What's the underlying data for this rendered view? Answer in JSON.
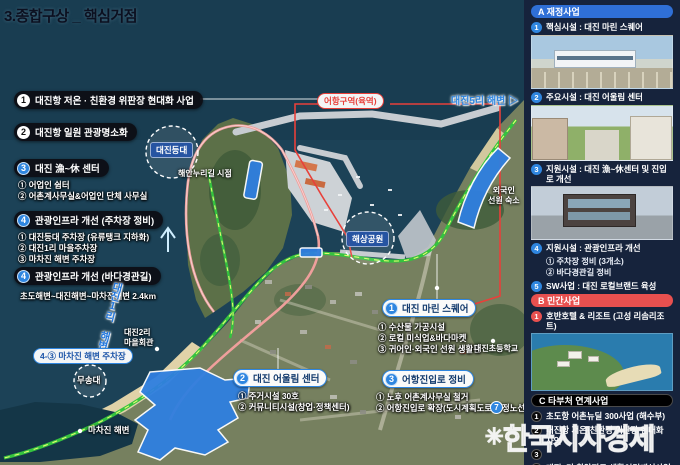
{
  "title": "3.종합구상 _ 핵심거점",
  "watermark": {
    "symbol": "✳",
    "text": "한국시사경제"
  },
  "colors": {
    "section_a": "#2f6fd6",
    "section_b": "#e8504f",
    "section_c": "#000000",
    "route_green": "#35c33f",
    "route_pink": "#ef9f9c",
    "boundary_red": "#e8403a",
    "site_blue": "#2f7fe0"
  },
  "map": {
    "callouts_left": [
      {
        "num": "1",
        "label": "대진항 저온 · 친환경 위판장 현대화 사업"
      },
      {
        "num": "2",
        "label": "대진항 일원 관광명소화"
      },
      {
        "num": "3",
        "label": "대진 漁~休 센터",
        "subs": [
          "① 어업인 쉼터",
          "② 어촌계사무실&어업인 단체 사무실"
        ]
      },
      {
        "num": "4",
        "label": "관광인프라 개선 (주차장 정비)",
        "subs": [
          "① 대진등대 주차장 (유류탱크 지하화)",
          "② 대진1리 마을주차장",
          "③ 마차진 해변 주차장"
        ]
      },
      {
        "num": "4",
        "label": "관광인프라 개선 (바다경관길)",
        "subs": [
          "초도해변~대진해변~마차진해변 2.4km"
        ]
      }
    ],
    "callouts_map": [
      {
        "num": "1",
        "label": "대진 마린 스퀘어",
        "subs": [
          "① 수산물 가공시설",
          "② 로컬 미식업&바다마켓",
          "③ 귀어인·외국인 선원 생활관"
        ]
      },
      {
        "num": "2",
        "label": "대진 어울림 센터",
        "subs": [
          "① 주거시설 30호",
          "② 커뮤니티시설(창업·정책센터)"
        ]
      },
      {
        "num": "3",
        "label": "어항진입로 정비",
        "subs": [
          "① 노후 어촌계사무실 철거",
          "② 어항진입로 확장(도시계획도로 결정노선)"
        ]
      }
    ],
    "labels": {
      "port_zone": "어항구역(육역)",
      "beach5": "대진5리 해변 ▷",
      "lighthouse": "대진등대",
      "trail_point": "해안누리길 시점",
      "marine_park": "해상공원",
      "foreign_line1": "외국인",
      "foreign_line2": "선원 숙소",
      "hall_line1": "대진2리",
      "hall_line2": "마을회관",
      "beach1_diag": "대진1리 해변",
      "parking43": "4-③ 마차진 해변 주차장",
      "musong": "무송대",
      "machajin_beach": "마차진 해변",
      "school": "대진초등학교",
      "marker7": "7"
    }
  },
  "sidebar": {
    "sections": [
      {
        "id": "A",
        "title": "A 재정사업",
        "items": [
          {
            "num": "1",
            "label": "핵심시설 : 대진 마린 스퀘어"
          },
          {
            "num": "2",
            "label": "주요시설 : 대진 어울림 센터"
          },
          {
            "num": "3",
            "label": "지원시설 : 대진 漁~休센터 및 진입로 개선"
          },
          {
            "num": "4",
            "label": "지원시설 : 관광인프라 개선",
            "subs": [
              "① 주차장 정비 (3개소)",
              "② 바다경관길 정비"
            ]
          },
          {
            "num": "5",
            "label": "SW사업 : 대진 로컬브랜드 육성"
          }
        ]
      },
      {
        "id": "B",
        "title": "B 민간사업",
        "items": [
          {
            "num": "1",
            "label": "호반호텔 & 리조트 (고성 리솜리조트)"
          }
        ]
      },
      {
        "id": "C",
        "title": "C 타부처 연계사업",
        "items": [
          {
            "num": "1",
            "label": "초도항 어촌뉴딜 300사업 (해수부)"
          },
          {
            "num": "2",
            "label": "대진항 저온·친환경 위판장 현대화 사업"
          },
          {
            "num": "3",
            "label": ""
          },
          {
            "num": "4",
            "label": "대진5리 취약지구 생활여건개선사업"
          },
          {
            "num": "5",
            "label": "화진포 해안누리길"
          }
        ]
      }
    ]
  }
}
